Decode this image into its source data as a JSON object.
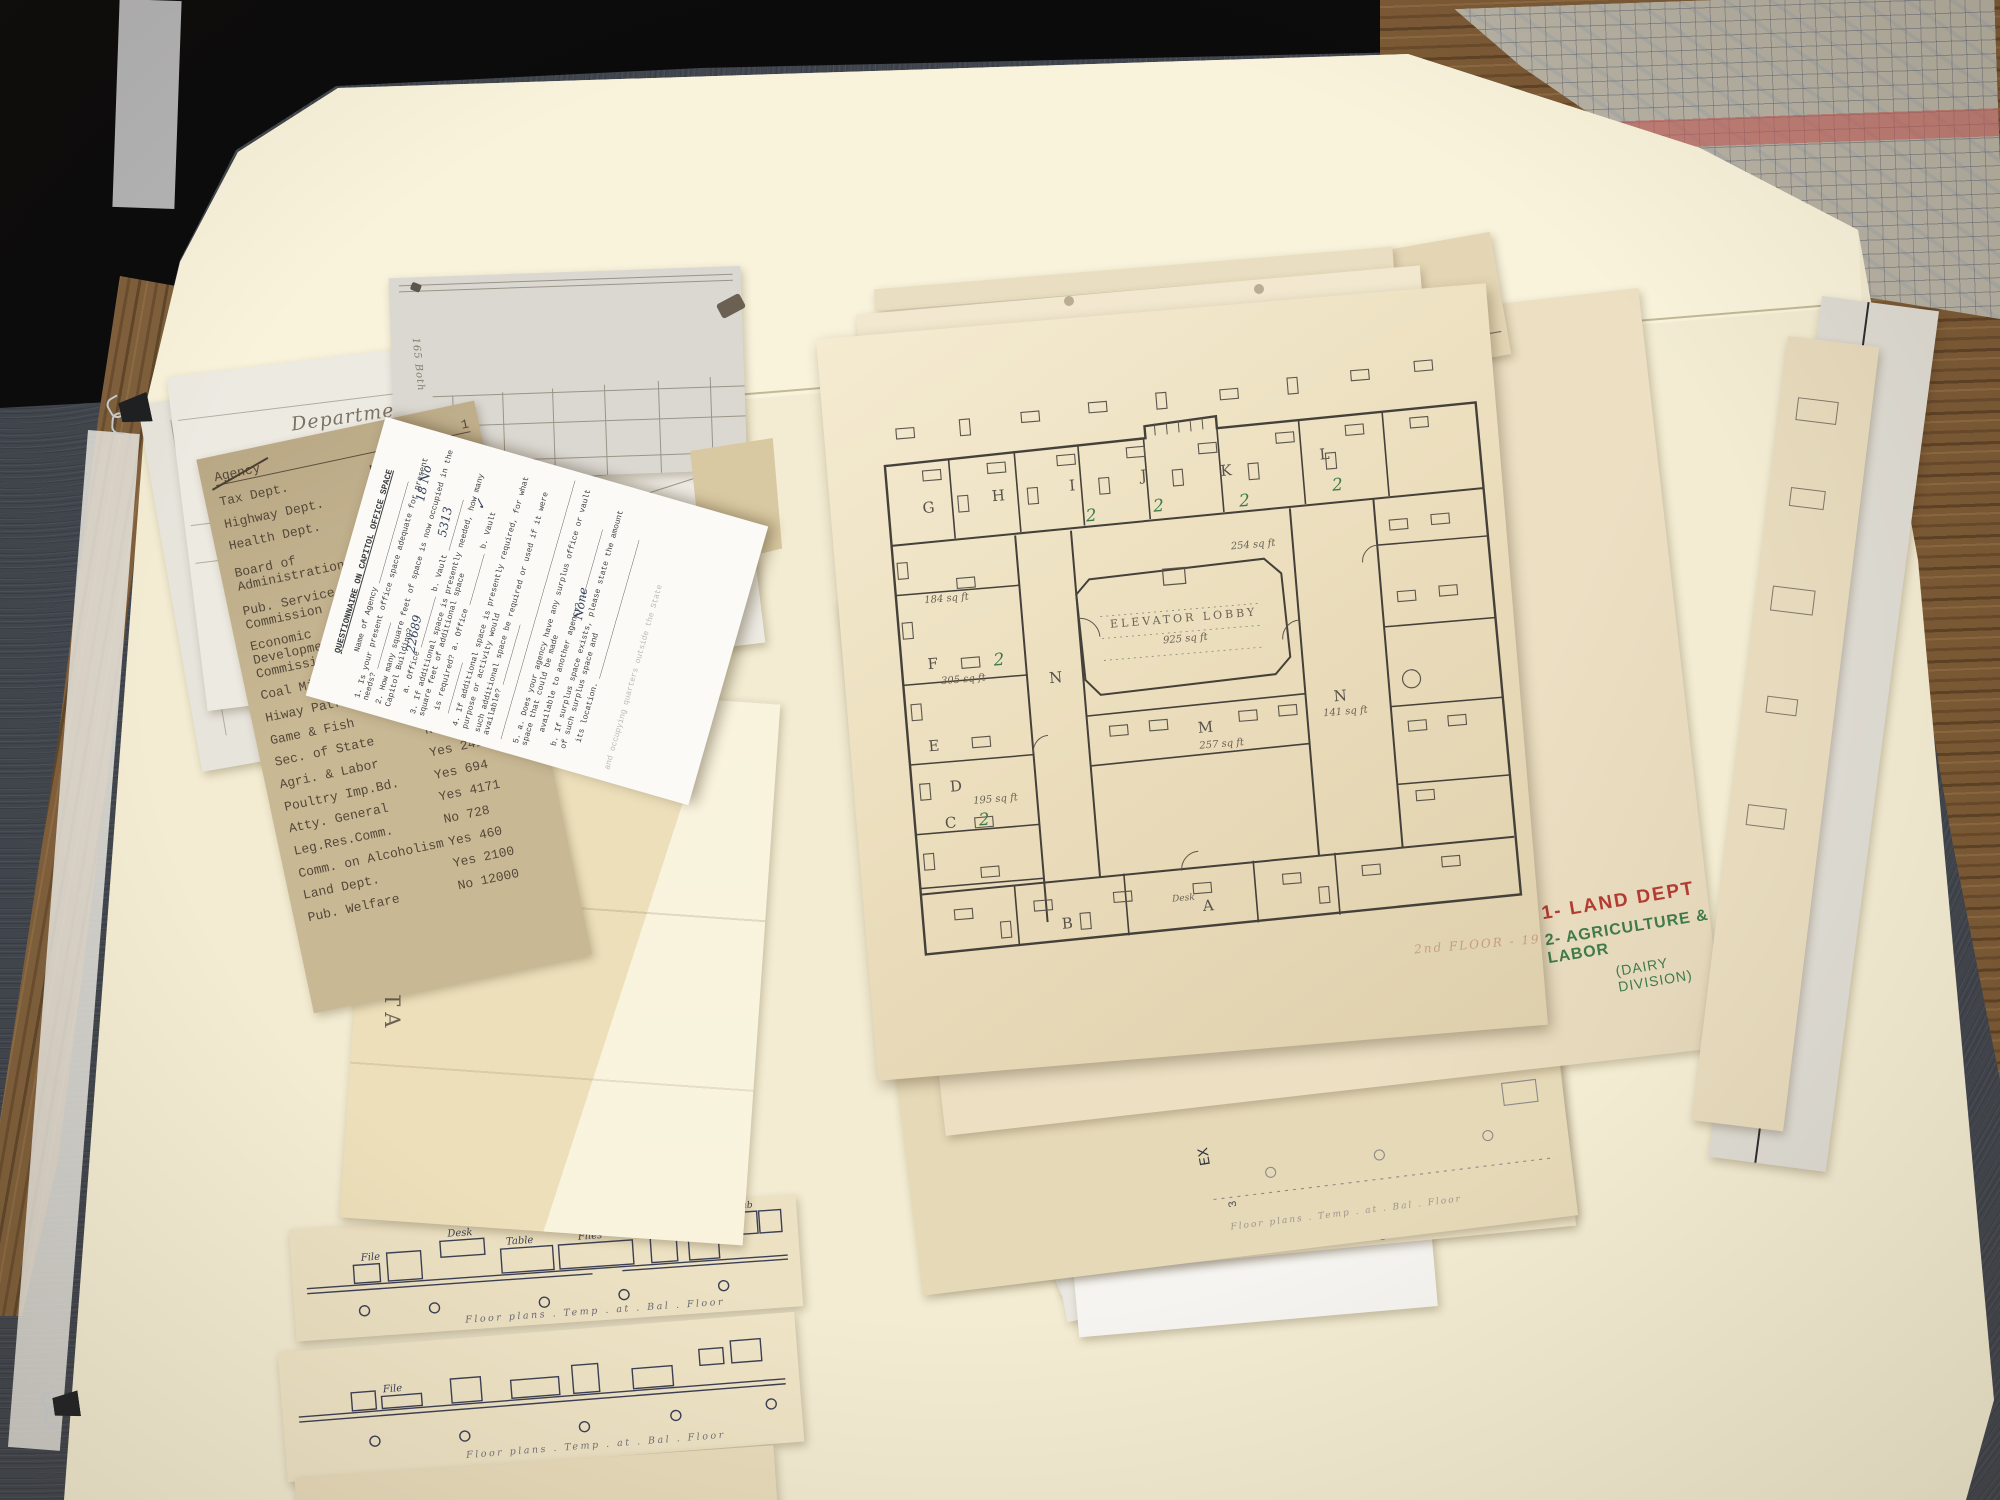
{
  "colors": {
    "carpet": "#41464e",
    "wood": "#7c5a36",
    "folder": "#f3ecd2",
    "folder_lid": "#f9f3dc",
    "plan_paper": "#eadcba",
    "questionnaire_paper": "#fbfaf6",
    "red_ink": "#b23b32",
    "green_ink": "#3f7a4a",
    "typewriter_ink": "#53483a",
    "pencil": "#5c564c"
  },
  "questionnaire": {
    "title": "QUESTIONNAIRE ON CAPITOL OFFICE SPACE",
    "name_line": "Name of Agency ______________________",
    "q1": "1.  Is your present office space adequate for present needs? __________",
    "q1_answer": "18 No",
    "q2": "2.  How many square feet of space is now occupied in the Capitol Building?",
    "q2ab": "a. Office ___________      b. Vault ___________",
    "q2a_answer": "22689",
    "q2b_answer": "5313",
    "q3": "3.  If additional space is presently needed, how many square feet of additional space",
    "q3b": "is required?   a. Office ___________      b. Vault ___________",
    "q3b_answer": "✓",
    "q4": "4.  If additional space is presently required, for what purpose or activity would",
    "q4b": "such additional space be required or used if it were available? _____________",
    "q4_blank": "________________________________________________________",
    "q5a": "5. a.  Does your agency have any surplus office or vault space that could be made",
    "q5a2": "available to another agency? _______________",
    "q5a_answer": "None",
    "q5b": "b.  If surplus space exists, please state the amount of such surplus space and",
    "q5b2": "its location. ______________________________",
    "q6": "and occupying quarters outside the State"
  },
  "agency_list": {
    "header": "Agency",
    "header_col": "1",
    "rows": [
      {
        "name": "Tax Dept.",
        "value": "No"
      },
      {
        "name": "Highway Dept.",
        "value": "No 1"
      },
      {
        "name": "Health Dept.",
        "value": "No 5"
      },
      {
        "name": "Board of Administration",
        "value": "No 1"
      },
      {
        "name": "Pub. Service Commission",
        "value": "Yes 54"
      },
      {
        "name": "Economic Development Commission",
        "value": "Yes 13"
      },
      {
        "name": "Coal Mine Inspector",
        "value": "Yes 30"
      },
      {
        "name": "Hiway Patrol",
        "value": "No 875"
      },
      {
        "name": "Game & Fish",
        "value": "No 2211"
      },
      {
        "name": "Sec. of State",
        "value": "No 1841"
      },
      {
        "name": "Agri. & Labor",
        "value": "Yes 2410"
      },
      {
        "name": "Poultry Imp.Bd.",
        "value": "Yes 694"
      },
      {
        "name": "Atty. General",
        "value": "Yes 4171"
      },
      {
        "name": "Leg.Res.Comm.",
        "value": "No 728"
      },
      {
        "name": "Comm. on Alcoholism",
        "value": "Yes 460"
      },
      {
        "name": "Land Dept.",
        "value": "Yes 2100"
      },
      {
        "name": "Pub. Welfare",
        "value": "No 12000"
      }
    ]
  },
  "instruction_sheet": {
    "line1": "Department of Public Instruction",
    "line2": "Case A",
    "line3": "Cornice",
    "dimension": "34"
  },
  "grid_sheet": {
    "side_note": "165 Both"
  },
  "folder_pack": {
    "label": "NORTH DAKOTA",
    "address": "Milwaukee Wis."
  },
  "floor_plan": {
    "rooms": [
      "G",
      "H",
      "I",
      "J",
      "K",
      "L",
      "F",
      "N",
      "M",
      "N",
      "E",
      "D",
      "C",
      "B",
      "A"
    ],
    "lobby_title": "ELEVATOR LOBBY",
    "lobby_area": "925 sq ft",
    "notes": [
      "184 sq ft",
      "305 sq ft",
      "195 sq ft",
      "254 sq ft",
      "257 sq ft",
      "141 sq ft"
    ],
    "desk_label": "Desk",
    "green_mark": "2",
    "caption": "2nd FLOOR - 1961",
    "legend_1": "1- LAND DEPT",
    "legend_2": "2- AGRICULTURE & LABOR",
    "legend_3": "(DAIRY DIVISION)"
  },
  "strip_sheets": {
    "caption": "Floor plans . Temp . at . Bal . Floor",
    "labels": {
      "desk": "Desk",
      "table": "Table",
      "files": "Files",
      "file": "File",
      "tab": "Tab"
    }
  },
  "right_stack": {
    "side_text": "EX",
    "side_num": "3",
    "red_side": "TION",
    "faint_caption": "Floor plans . Temp . at . Bal . Floor"
  }
}
